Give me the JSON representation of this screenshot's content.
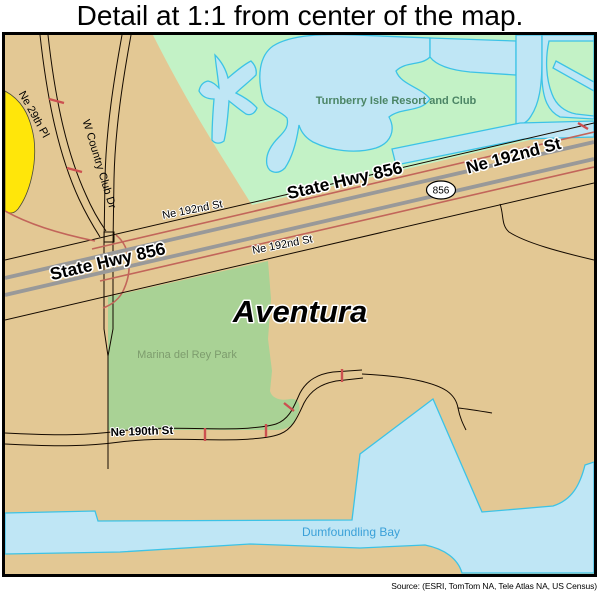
{
  "title": "Detail at 1:1 from center of the map.",
  "source": "Source: (ESRI, TomTom NA, Tele Atlas NA, US Census)",
  "map": {
    "city_label": "Aventura",
    "resort_label": "Turnberry Isle Resort and Club",
    "park_label": "Marina del Rey Park",
    "bay_label": "Dumfoundling Bay",
    "highway_shield": "856",
    "roads": {
      "state_hwy_856_west": "State Hwy 856",
      "state_hwy_856_east": "State Hwy 856",
      "ne_192nd_st_major": "Ne 192nd St",
      "ne_192nd_st_north": "Ne 192nd St",
      "ne_192nd_st_south": "Ne 192nd St",
      "ne_190th_st": "Ne 190th St",
      "ne_29th_pl": "Ne 29th Pl",
      "w_country_club_dr": "W Country Club Dr"
    },
    "colors": {
      "land": "#e3c894",
      "resort_green": "#c3f2c6",
      "park_green": "#a9d295",
      "water_fill": "#bfe6f5",
      "water_stroke": "#3cc3e6",
      "highway_gray": "#999999",
      "ramp_red": "#c2655a",
      "yellow_area": "#ffe60a",
      "resort_label_color": "#4b8565",
      "park_label_color": "#7d9c6d",
      "bay_label_color": "#3aa0d8"
    }
  }
}
